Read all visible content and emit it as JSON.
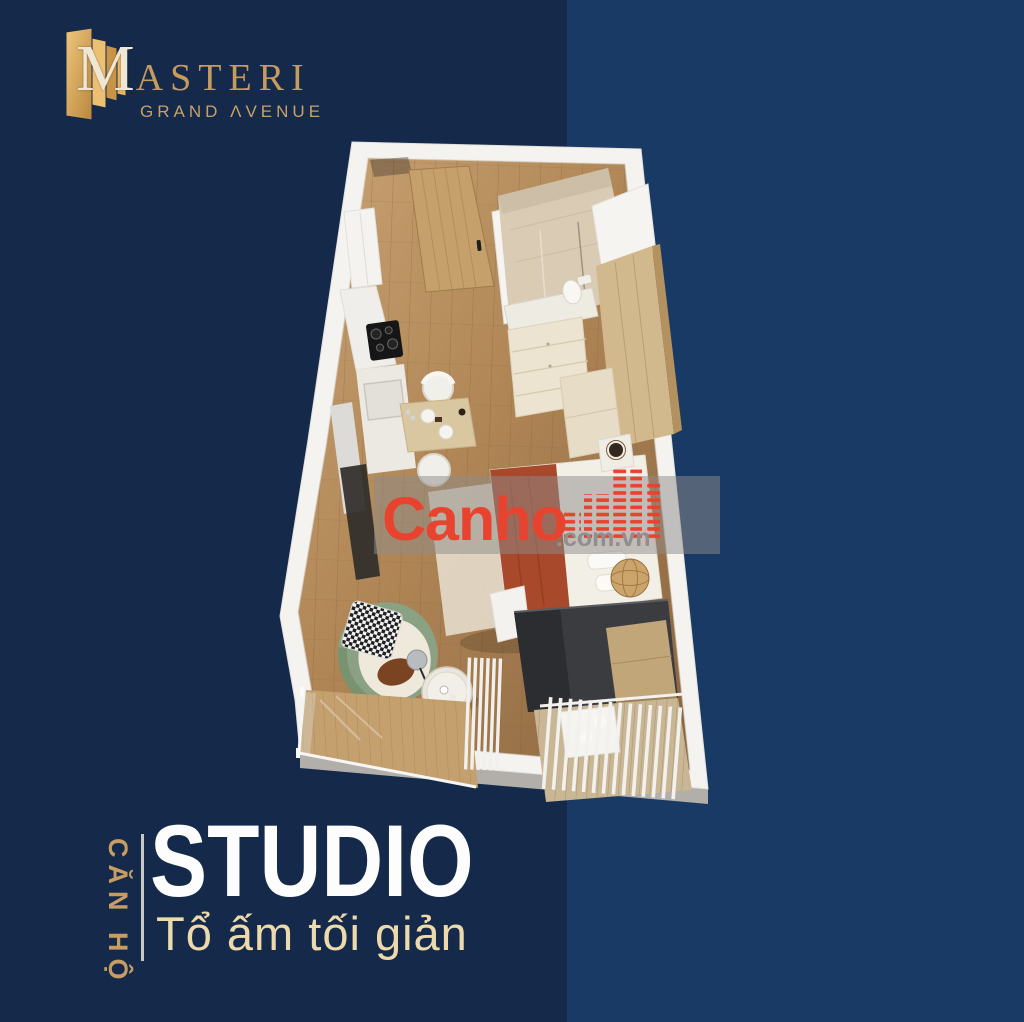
{
  "background": {
    "left_color": "#15294a",
    "right_color": "#1a3a66",
    "split_x": 567
  },
  "logo": {
    "brand_initial": "M",
    "brand_rest": "ASTERI",
    "tagline": "GRAND ΛVENUE",
    "gold_color": "#c79a5e"
  },
  "watermark": {
    "brand": "Canho",
    "suffix": ".com.vn",
    "red_color": "#e8432e",
    "gray_color": "#8f8f8f"
  },
  "caption": {
    "vertical_label": "CĂN HỘ",
    "title": "STUDIO",
    "subtitle": "Tổ ấm tối giản",
    "title_color": "#fdfdfd",
    "accent_color": "#c89d63",
    "subtitle_color": "#ecd9ac"
  },
  "floor_plan": {
    "view": "isometric-3d-cutaway",
    "unit_type": "studio",
    "areas": [
      "entrance-door",
      "kitchenette",
      "dining-for-two",
      "bathroom-shower",
      "wardrobe",
      "dresser",
      "sleeping-area",
      "tv-console",
      "desk",
      "armchair-corner",
      "coffee-table",
      "balcony-glass-railing",
      "balcony-louvered"
    ]
  }
}
